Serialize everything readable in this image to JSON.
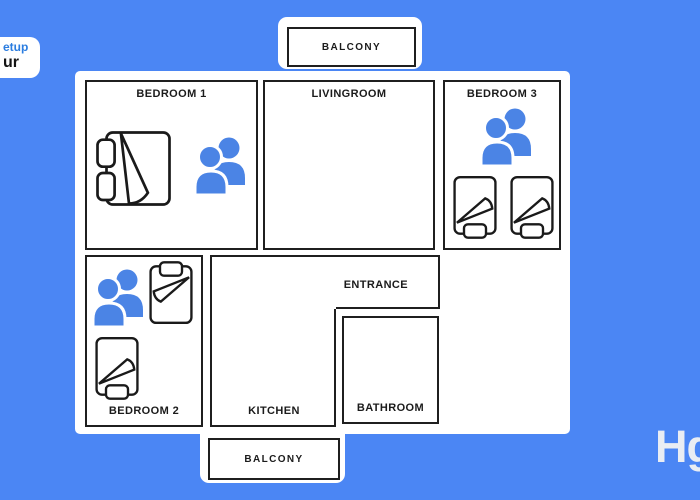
{
  "canvas": {
    "width": 700,
    "height": 500
  },
  "colors": {
    "background": "#4b86f4",
    "person_icon": "#4b84e5",
    "room_border": "#1f1f1f",
    "label_text": "#1b1b1b",
    "widget_top_text": "#2b7de0",
    "widget_bottom_text": "#141414",
    "logo_text": "#e9edf3"
  },
  "setup_widget": {
    "line1": "etup",
    "line2": "ur"
  },
  "balcony_top": {
    "label": "BALCONY"
  },
  "balcony_bottom": {
    "label": "BALCONY"
  },
  "rooms": {
    "bedroom1": {
      "label": "BEDROOM 1",
      "icons": [
        "double-bed-icon",
        "two-people-icon"
      ]
    },
    "livingroom": {
      "label": "LIVINGROOM",
      "icons": []
    },
    "bedroom3": {
      "label": "BEDROOM 3",
      "icons": [
        "two-people-icon",
        "single-bed-icon",
        "single-bed-icon"
      ]
    },
    "bedroom2": {
      "label": "BEDROOM 2",
      "icons": [
        "two-people-icon",
        "single-bed-icon",
        "single-bed-icon"
      ]
    },
    "entrance": {
      "label": "ENTRANCE"
    },
    "kitchen": {
      "label": "KITCHEN"
    },
    "bathroom": {
      "label": "BATHROOM"
    }
  },
  "logo": {
    "text": "Hg"
  }
}
